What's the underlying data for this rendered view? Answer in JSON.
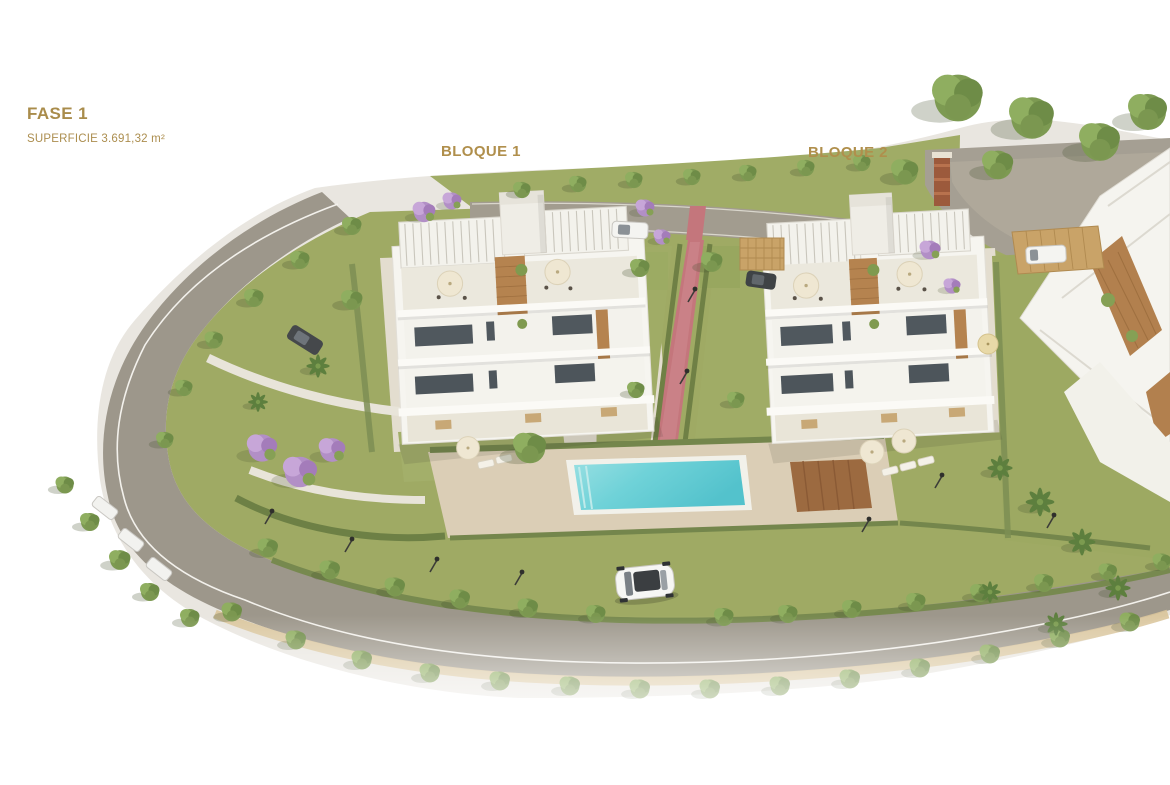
{
  "header": {
    "phase": "FASE 1",
    "surface": "SUPERFICIE 3.691,32 m²"
  },
  "blocks": {
    "block1": "BLOQUE 1",
    "block2": "BLOQUE 2"
  },
  "colors": {
    "label_gold": "#a98c4b",
    "grass_green": "#9faa64",
    "hedge_green": "#74864c",
    "tree_green": "#7d9a52",
    "jacaranda_purple": "#b28fc6",
    "road_gray": "#9d978b",
    "sidewalk_beige": "#e9e6e0",
    "pool_water": "#66cdd4",
    "pool_deck_beige": "#dbceb6",
    "wood_deck_brown": "#9c6a40",
    "building_white": "#f5f4ef",
    "building_wood": "#b5834f",
    "path_red": "#c4767c"
  },
  "scene": {
    "description": "Aerial 3D render of residential phase 1: two white apartment blocks with rooftop pergolas, communal pool with sun deck, gardens, red pedestrian path, perimeter road lined with trees, and a partial third building at right",
    "vehicles": [
      "white car on lower road",
      "dark car on upper left road",
      "white car parked on top road",
      "white van under carport",
      "dark car under carport",
      "parked cars along left road"
    ]
  }
}
